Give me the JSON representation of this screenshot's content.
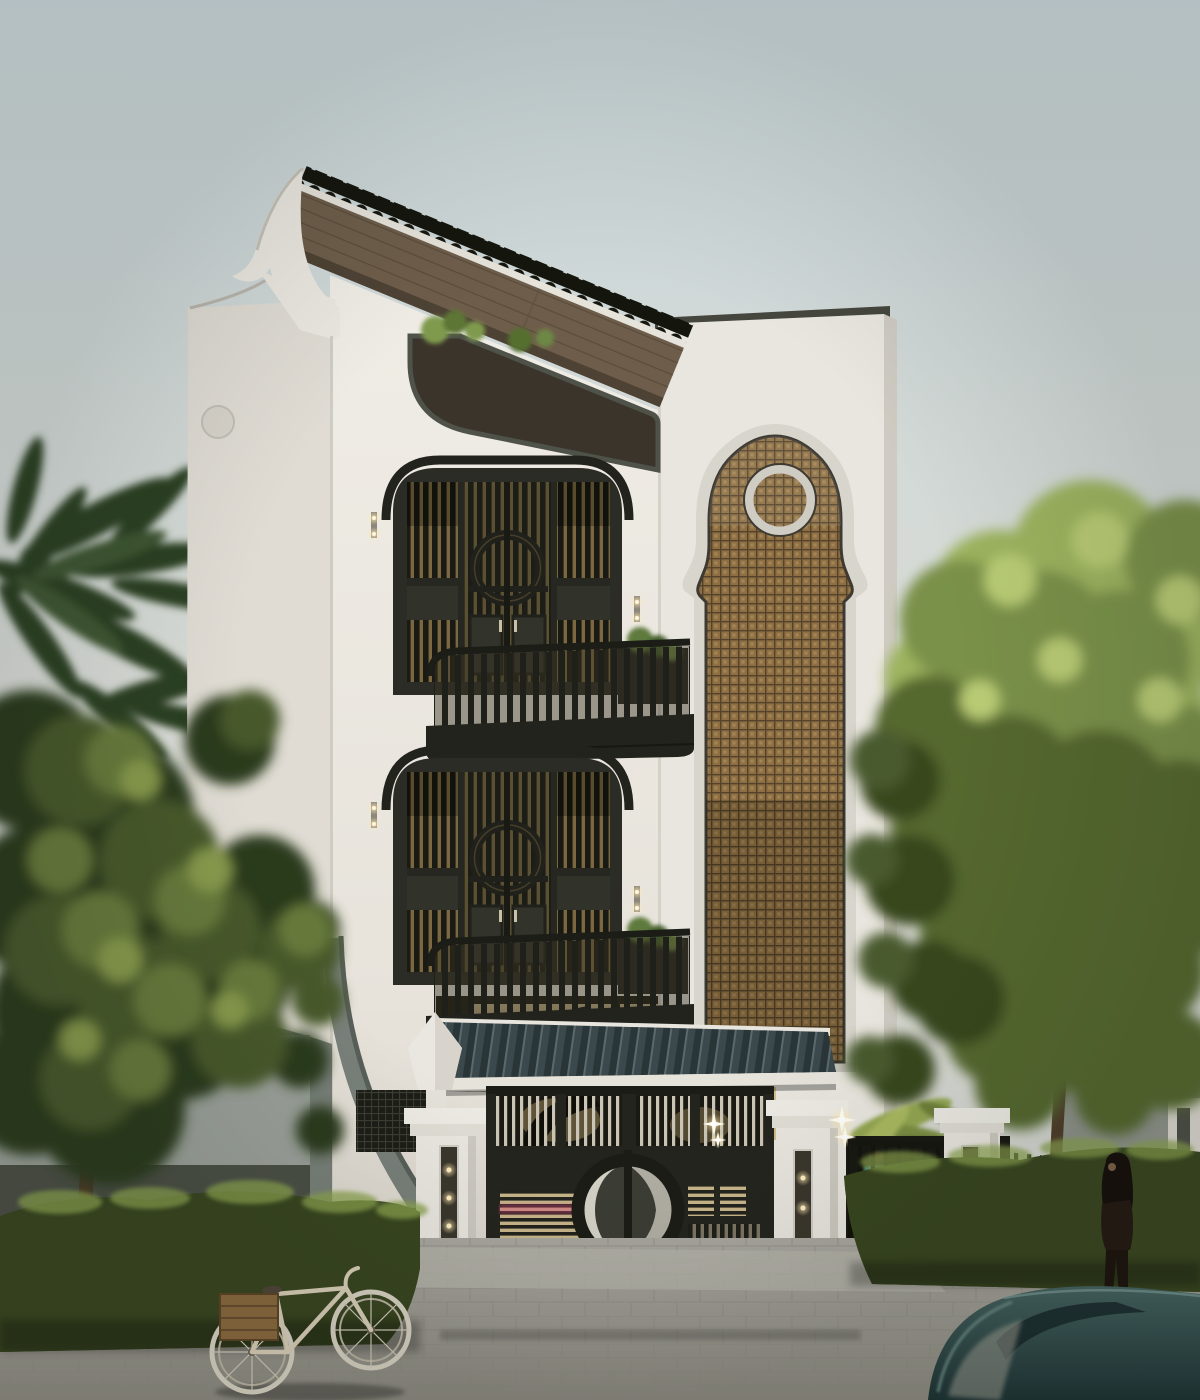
{
  "meta": {
    "kind": "architectural-exterior-render",
    "subject": "three-storey Indochine style townhouse at dusk",
    "weather": "overcast pale sky"
  },
  "palette": {
    "sky_top": "#c9d6d9",
    "sky_low": "#dadcd6",
    "facade": "#edeae3",
    "facade_side": "#e0dcd4",
    "tower": "#e9e6df",
    "frame_dark": "#2b2c25",
    "door_olive": "#3a3b31",
    "lattice": "#8d6f43",
    "lattice_line": "#54422a",
    "molding": "#d8d5cd",
    "wood_soffit": "#6e5d4a",
    "roof_crest": "#14150d",
    "gate_metal": "#23241d",
    "gate_tile": "#3b484c",
    "slat_light": "#cbc5b6",
    "warm_light": "#ffe9b0",
    "taillight_pink": "#e0457f",
    "pillar_white": "#eae7e0",
    "plinth_black": "#23241e",
    "hedge": "#39451f",
    "hedge_speckle": "#8ba84f",
    "foliage_dark": "#2b3a1e",
    "foliage_light": "#86994b",
    "palm_dark": "#2c4023",
    "pavement": "#a6a49c",
    "car_teal": "#2e4b4a",
    "bike_cream": "#d9cfb8",
    "crate_brown": "#8a693e",
    "neighbor_wall": "#9aa099",
    "trunk_brown": "#4a3a28"
  },
  "scene": {
    "building": {
      "storeys": 3,
      "balconies": 2,
      "roof": "black crested tile ridge over timber soffit with curved white gable",
      "screen_panel": "tall arched rattan lattice with circular medallion",
      "windows": "dark olive arched frames, slatted shutters, circle-motif double doors",
      "lights": [
        "paired wall sconces",
        "balcony downlights",
        "roof terrace railing with plants"
      ]
    },
    "gate": {
      "leaves": 2,
      "motif": "split circle medallion",
      "roof": "tiled pent canopy with white fascia and side arch",
      "pillars": 4,
      "lamps": [
        "recessed slot sconces",
        "starburst lights"
      ],
      "behind": [
        "spiral stair silhouette",
        "pink car tail-light glow"
      ]
    },
    "street": {
      "surface": "grey stone pavers with smooth driveway apron",
      "hedges": 2,
      "bicycle": "cream frame with timber crate over rear wheel",
      "car": "dark teal car roof in right foreground",
      "figures": [
        "woman with long dark hair walking on sidewalk",
        "man in plaid shirt inside gate fence"
      ]
    },
    "vegetation": [
      "palm fronds upper left",
      "broadleaf tree left",
      "sunlit trees right",
      "clipped hedges",
      "tropical plants at gate"
    ]
  }
}
